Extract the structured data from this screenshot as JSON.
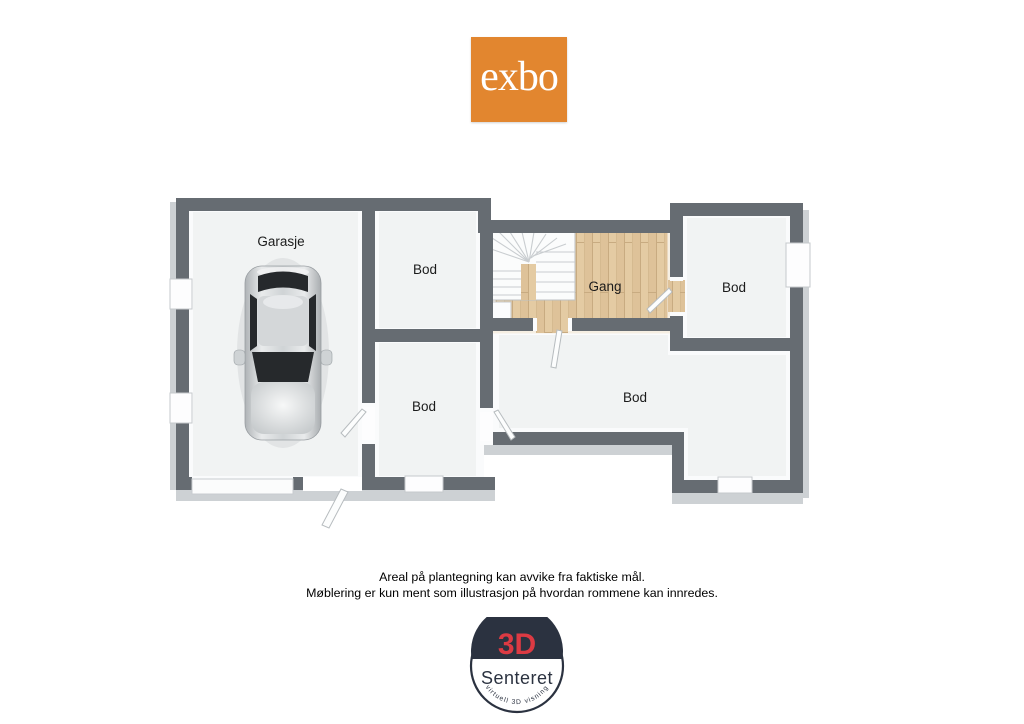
{
  "logo": {
    "text": "exbo"
  },
  "floorplan": {
    "rooms": [
      {
        "label": "Garasje",
        "x": 281,
        "y": 246
      },
      {
        "label": "Bod",
        "x": 425,
        "y": 274
      },
      {
        "label": "Gang",
        "x": 605,
        "y": 291
      },
      {
        "label": "Bod",
        "x": 734,
        "y": 292
      },
      {
        "label": "Bod",
        "x": 424,
        "y": 411
      },
      {
        "label": "Bod",
        "x": 635,
        "y": 402
      }
    ],
    "features": [
      "staircase",
      "car-in-garage",
      "wood-floor-hall"
    ]
  },
  "disclaimer": {
    "line1": "Areal på plantegning kan avvike fra faktiske mål.",
    "line2": "Møblering er kun ment som illustrasjon på hvordan rommene kan innredes."
  },
  "badge": {
    "top": "3D",
    "name": "Senteret",
    "tagline": "virtuell 3D visning"
  },
  "colors": {
    "exbo_orange": "#E2862F",
    "wall_gray": "#666C72",
    "wood_beige": "#E4CBA3",
    "badge_navy": "#2B3240",
    "badge_red": "#DC3A43"
  }
}
